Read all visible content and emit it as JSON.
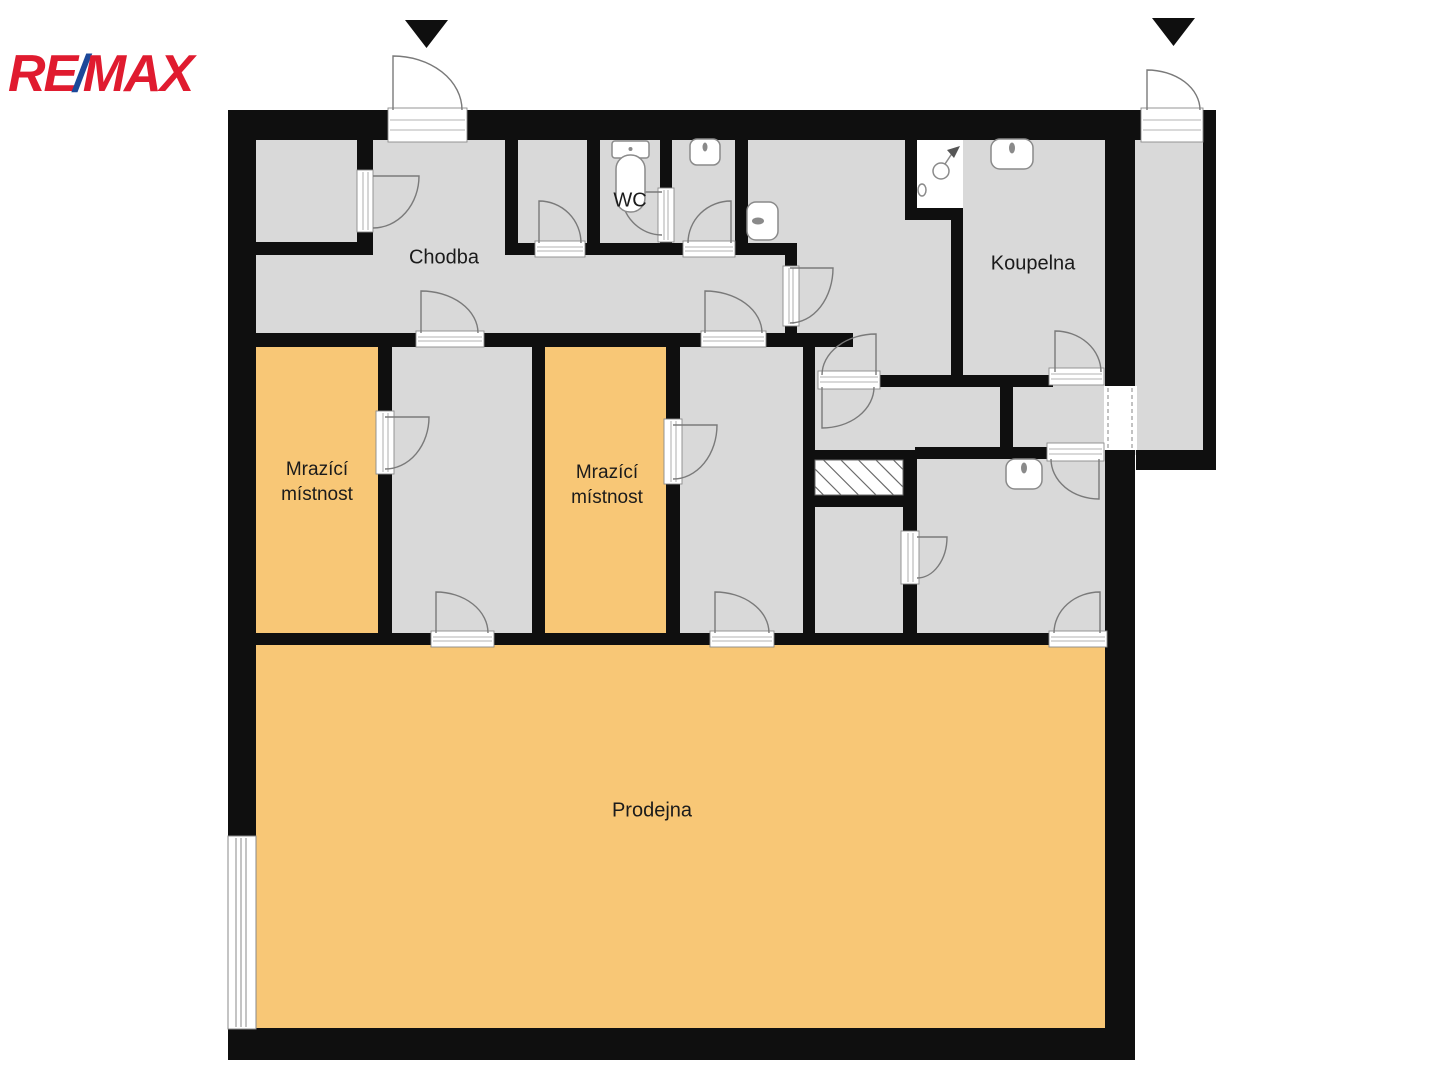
{
  "logo": {
    "re": "RE",
    "slash": "/",
    "max": "MAX"
  },
  "rooms": {
    "chodba": "Chodba",
    "wc": "WC",
    "koupelna": "Koupelna",
    "mrazici_1": {
      "line1": "Mrazící",
      "line2": "místnost"
    },
    "mrazici_2": {
      "line1": "Mrazící",
      "line2": "místnost"
    },
    "prodejna": "Prodejna"
  },
  "colors": {
    "wall": "#0f0f0f",
    "room_gray": "#d9d9d9",
    "room_orange": "#f8c776",
    "logo_red": "#e01b2f",
    "logo_blue": "#1c4899",
    "door_line": "#7a7a7a"
  },
  "fixtures": [
    "toilet-icon",
    "washbasin-icon",
    "urinal-icon",
    "shower-icon",
    "washbasin-icon",
    "washbasin-icon"
  ],
  "entrance_arrows": 2
}
